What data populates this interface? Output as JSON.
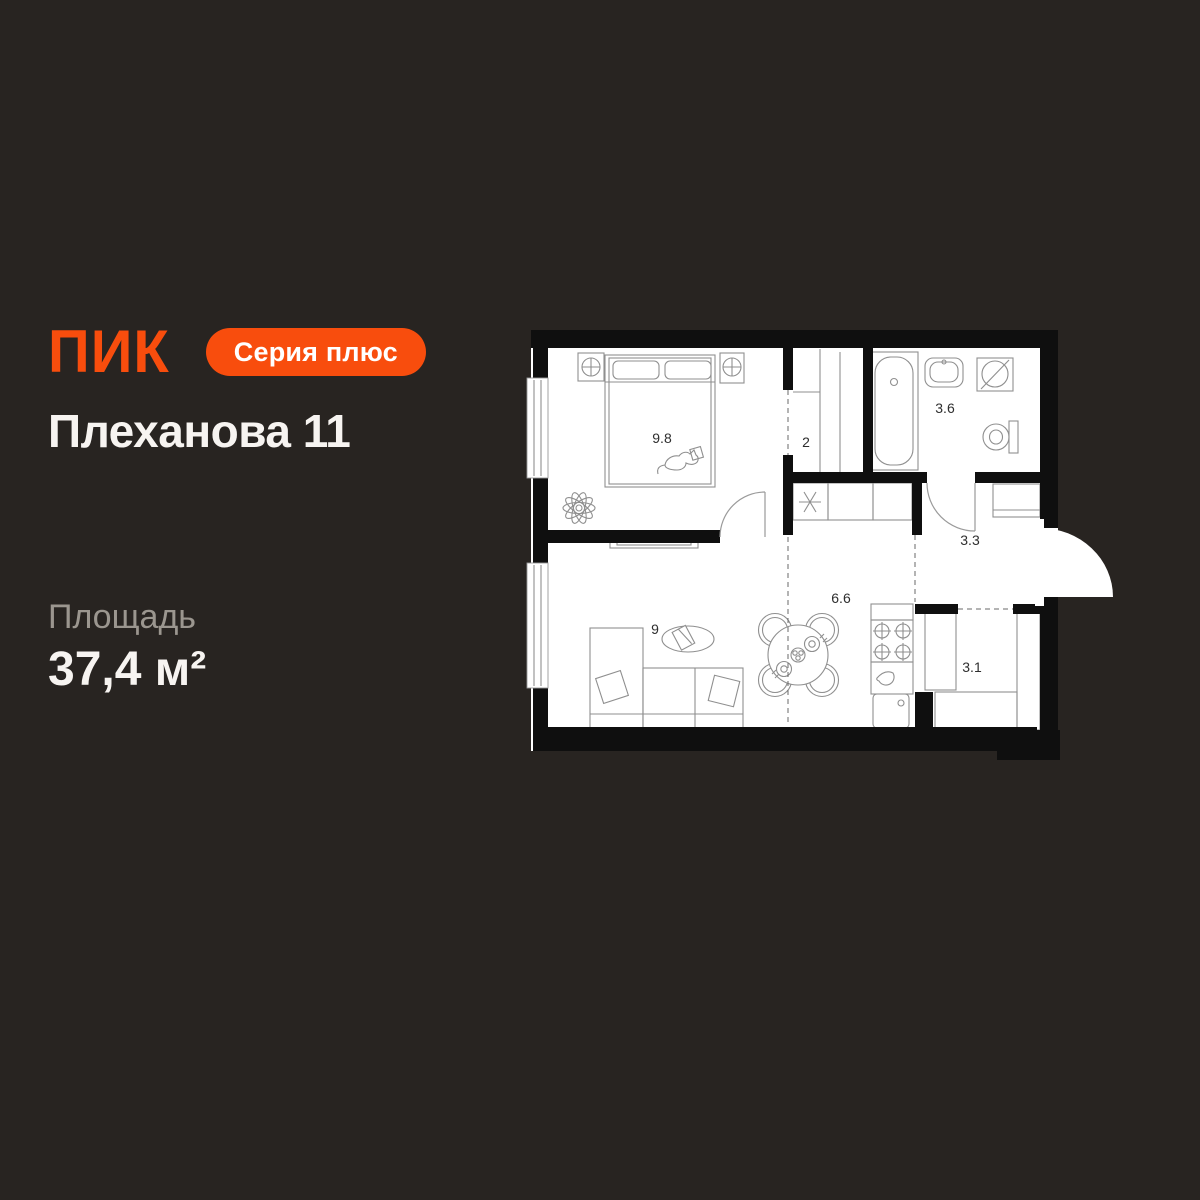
{
  "brand": {
    "logo_text": "ПИК",
    "badge_label": "Серия плюс"
  },
  "header": {
    "title": "Плеханова 11"
  },
  "area": {
    "label": "Площадь",
    "value": "37,4 м²"
  },
  "floor_plan": {
    "rooms": [
      {
        "id": "bedroom",
        "area_label": "9.8"
      },
      {
        "id": "wardrobe",
        "area_label": "2"
      },
      {
        "id": "bathroom",
        "area_label": "3.6"
      },
      {
        "id": "hallway",
        "area_label": "3.3"
      },
      {
        "id": "kitchen",
        "area_label": "6.6"
      },
      {
        "id": "living-room",
        "area_label": "9"
      },
      {
        "id": "storage",
        "area_label": "3.1"
      }
    ]
  },
  "colors": {
    "background": "#282421",
    "accent_orange": "#F84D0D",
    "plan_background": "#FFFFFF",
    "wall": "#0F0F0F",
    "muted_text": "#9B968F",
    "primary_text": "#F7F4F1"
  }
}
